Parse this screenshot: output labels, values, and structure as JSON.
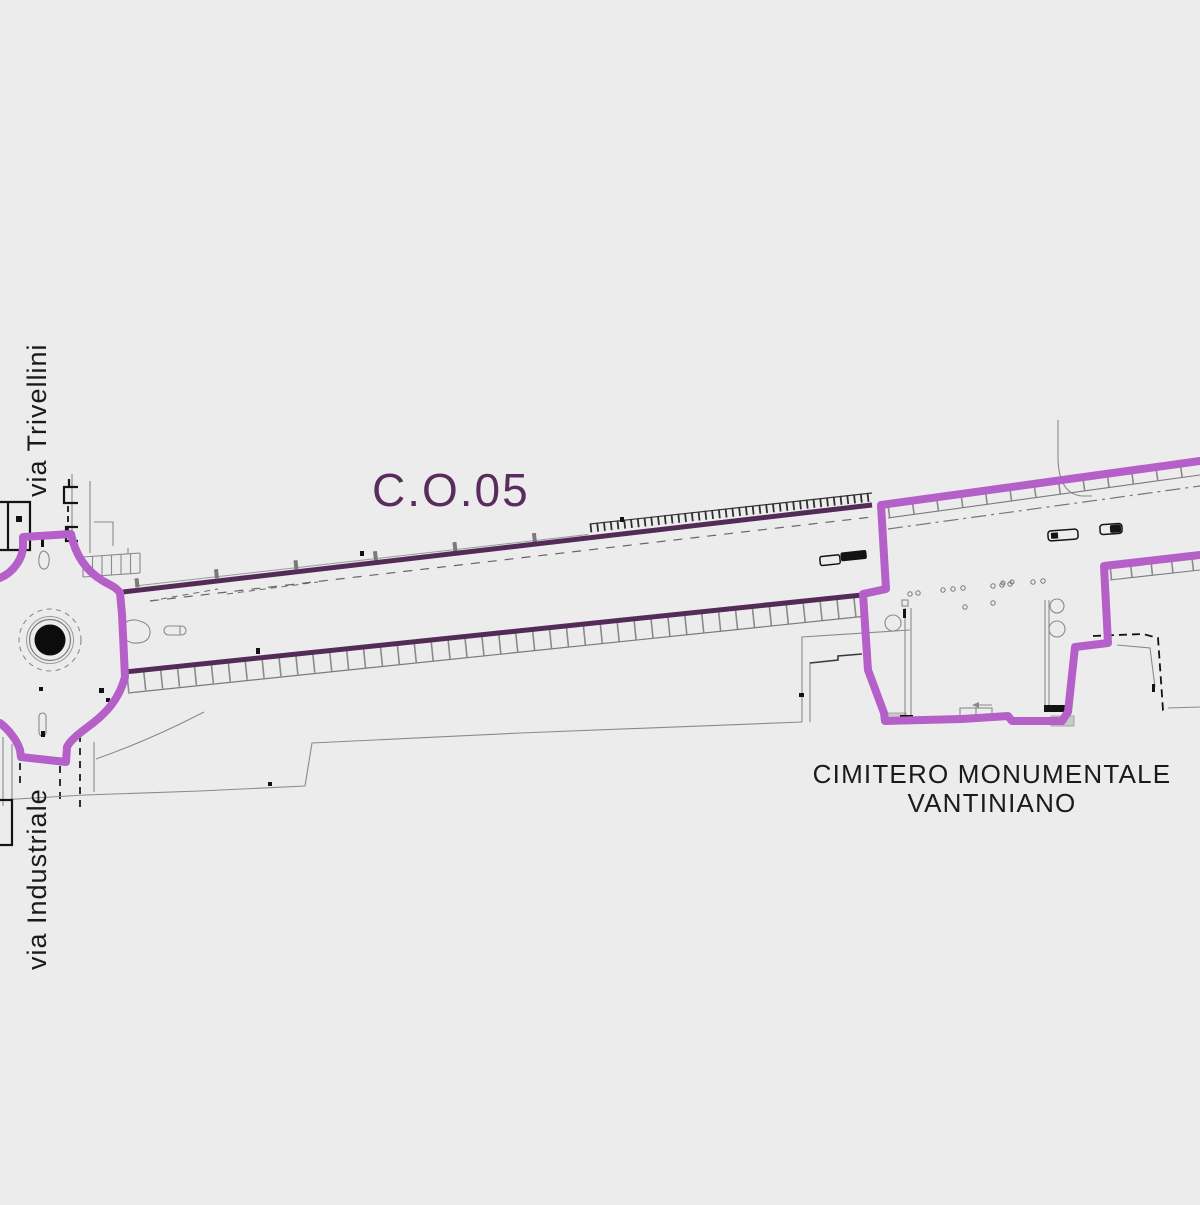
{
  "labels": {
    "project_code": "C.O.05",
    "street_top": "via Trivellini",
    "street_bottom": "via Industriale",
    "cemetery_line1": "CIMITERO MONUMENTALE",
    "cemetery_line2": "VANTINIANO"
  },
  "colors": {
    "background": "#ececec",
    "boundary_magenta": "#b55fc8",
    "road_edge_plum": "#542b58",
    "project_code_text": "#5a2c5e",
    "label_text": "#1a1a1a",
    "linework_gray": "#8a8a8a"
  }
}
